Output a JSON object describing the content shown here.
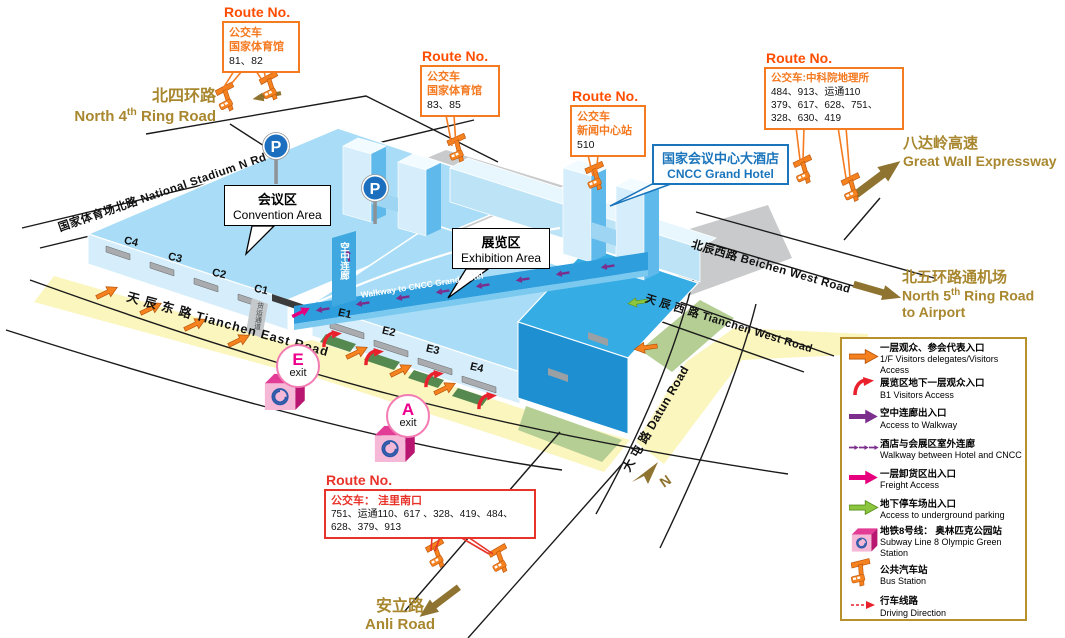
{
  "colors": {
    "orange_accent": "#F6821F",
    "route_border": "#F47B20",
    "route_title": "#FF4D00",
    "red_accent": "#E8332A",
    "blue_label": "#1B75BC",
    "gold_text": "#A8872F",
    "gold_arrow": "#8F7330",
    "building_light": "#A9DDF7",
    "building_dark": "#2BA8E1",
    "walkway_blue": "#2E9EDC",
    "plaza_yellow": "#FBF5BE",
    "lawn_green": "#B5CE94",
    "purple": "#7B2E8C",
    "magenta": "#E6007E",
    "green_arrow": "#8CC63E",
    "pink": "#EC008C",
    "legend_border": "#B8912D"
  },
  "route_boxes": {
    "box_81_82": {
      "title": "Route No.",
      "lines": [
        "公交车",
        "国家体育馆"
      ],
      "numbers": [
        "81、82"
      ]
    },
    "box_83_85": {
      "title": "Route No.",
      "lines": [
        "公交车",
        "国家体育馆"
      ],
      "numbers": [
        "83、85"
      ]
    },
    "box_510": {
      "title": "Route No.",
      "lines": [
        "公交车",
        "新闻中心站"
      ],
      "numbers": [
        "510"
      ]
    },
    "box_cas": {
      "title": "Route No.",
      "lines": [
        "公交车:中科院地理所"
      ],
      "numbers": [
        "484、913、运通110",
        "379、617、628、751、",
        "328、630、419"
      ]
    },
    "box_wali": {
      "title": "Route No.",
      "lines": [
        "公交车： 洼里南口"
      ],
      "numbers": [
        "751、运通110、617 、328、419、484、",
        "628、379、913"
      ]
    }
  },
  "callouts": {
    "convention": {
      "cn": "会议区",
      "en": "Convention Area"
    },
    "exhibition": {
      "cn": "展览区",
      "en": "Exhibition Area"
    },
    "hotel": {
      "cn": "国家会议中心大酒店",
      "en": "CNCC Grand Hotel"
    }
  },
  "roads": {
    "north4th": {
      "cn": "北四环路",
      "en_pre": "North 4",
      "sup": "th",
      "en_post": " Ring Road"
    },
    "national_stadium": "国家体育场北路   National Stadium N Rd",
    "beichen_west": "北辰西路   Beichen West Road",
    "tianchen_west": "天 辰 西 路  Tianchen West Road",
    "tianchen_east": "天  辰  东  路   Tianchen East Road",
    "datun": "大 屯 路   Datun Road",
    "great_wall": {
      "cn": "八达岭高速",
      "en": "Great Wall Expressway"
    },
    "north5th": {
      "cn": "北五环路通机场",
      "en_pre": "North 5",
      "sup": "th",
      "en_post": " Ring Road",
      "en2": "to Airport"
    },
    "anli": {
      "cn": "安立路",
      "en": "Anli Road"
    }
  },
  "map_texts": {
    "walkway_cn": "空中连廊",
    "walkway_en": "Walkway to CNCC Grand Hotel",
    "c_doors": [
      "C4",
      "C3",
      "C2",
      "C1"
    ],
    "e_doors": [
      "E1",
      "E2",
      "E3",
      "E4"
    ],
    "exit_e": "E",
    "exit_a": "A",
    "exit_word": "exit",
    "freight_passage": "货运通道",
    "compass": "N",
    "parking": "P"
  },
  "legend": {
    "items": [
      {
        "icon": "arrow-orange",
        "cn": "一层观众、参会代表入口",
        "en": "1/F Visitors  delegates/Visitors Access"
      },
      {
        "icon": "arrow-red-curved",
        "cn": "展览区地下一层观众入口",
        "en": "B1 Visitors Access"
      },
      {
        "icon": "arrow-purple",
        "cn": "空中连廊出入口",
        "en": "Access to Walkway"
      },
      {
        "icon": "arrow-purple-dashed",
        "cn": "酒店与会展区室外连廊",
        "en": "Walkway between Hotel and CNCC"
      },
      {
        "icon": "arrow-magenta",
        "cn": "一层卸货区出入口",
        "en": "Freight Access"
      },
      {
        "icon": "arrow-green",
        "cn": "地下停车场出入口",
        "en": "Access to underground parking"
      },
      {
        "icon": "subway-cube",
        "cn": "地铁8号线： 奥林匹克公园站",
        "en": "Subway Line 8  Olympic Green Station"
      },
      {
        "icon": "bus-station",
        "cn": "公共汽车站",
        "en": "Bus Station"
      },
      {
        "icon": "arrow-red-dashed",
        "cn": "行车线路",
        "en": "Driving Direction"
      }
    ]
  }
}
